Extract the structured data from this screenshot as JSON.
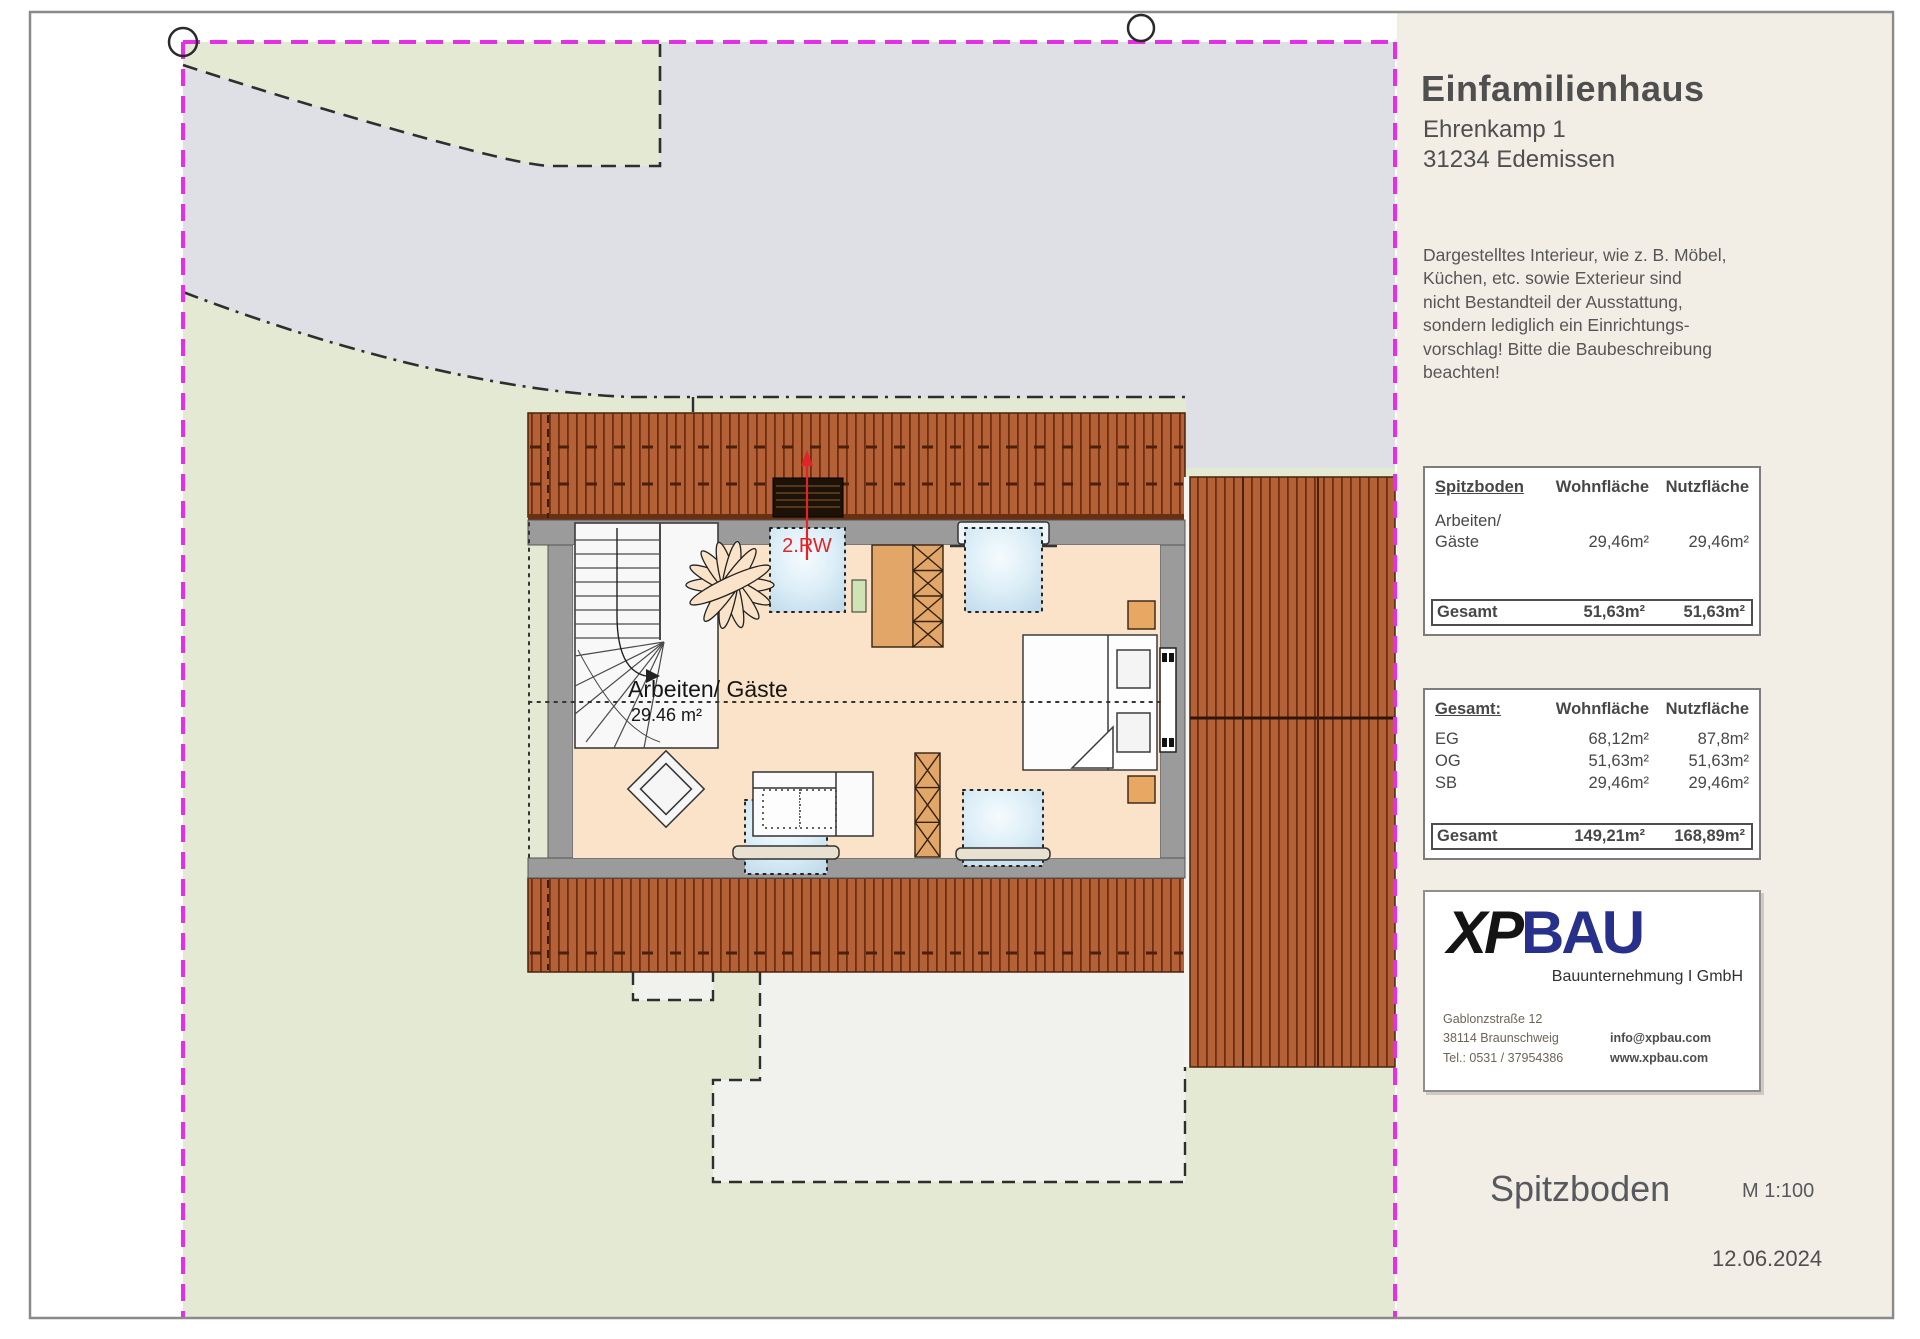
{
  "project": {
    "title": "Einfamilienhaus",
    "address_line1": "Ehrenkamp 1",
    "address_line2": "31234 Edemissen"
  },
  "disclaimer_lines": [
    "Dargestelltes Interieur, wie z. B. Möbel,",
    "Küchen, etc. sowie Exterieur sind",
    "nicht Bestandteil der Ausstattung,",
    "sondern lediglich ein Einrichtungs-",
    "vorschlag! Bitte die Baubeschreibung",
    "beachten!"
  ],
  "plan": {
    "room_label": "Arbeiten/ Gäste",
    "room_area": "29.46 m²",
    "vent_label": "2.RW"
  },
  "panel": {
    "area_table": {
      "col0": "Spitzboden",
      "col1": "Wohnfläche",
      "col2": "Nutzfläche",
      "row_label_line1": "Arbeiten/",
      "row_label_line2": "Gäste",
      "row_wohn": "29,46m²",
      "row_nutz": "29,46m²",
      "total_label": "Gesamt",
      "total_wohn": "51,63m²",
      "total_nutz": "51,63m²"
    },
    "summary_table": {
      "col0": "Gesamt:",
      "col1": "Wohnfläche",
      "col2": "Nutzfläche",
      "rows": [
        {
          "label": "EG",
          "wohn": "68,12m²",
          "nutz": "87,8m²"
        },
        {
          "label": "OG",
          "wohn": "51,63m²",
          "nutz": "51,63m²"
        },
        {
          "label": "SB",
          "wohn": "29,46m²",
          "nutz": "29,46m²"
        }
      ],
      "total_label": "Gesamt",
      "total_wohn": "149,21m²",
      "total_nutz": "168,89m²"
    },
    "logo": {
      "part1": "XP",
      "part2": "BAU",
      "subtitle": "Bauunternehmung I GmbH",
      "address1": "Gablonzstraße 12",
      "address2": "38114 Braunschweig",
      "phone": "Tel.: 0531 / 37954386",
      "email": "info@xpbau.com",
      "web": "www.xpbau.com"
    },
    "sheet_title": "Spitzboden",
    "scale": "M 1:100",
    "date": "12.06.2024"
  },
  "colors": {
    "boundary_magenta": "#e52ee5",
    "roof_brown": "#b46138",
    "roof_stripe": "#6e2e0f",
    "site_green": "#e3e9d3",
    "driveway_gray": "#dfe0e6",
    "room_cream": "#fae3c8",
    "wall_gray": "#9b9b9b",
    "panel_cream": "#f3eee5",
    "logo_blue": "#27318c",
    "marker_red": "#e02427"
  }
}
